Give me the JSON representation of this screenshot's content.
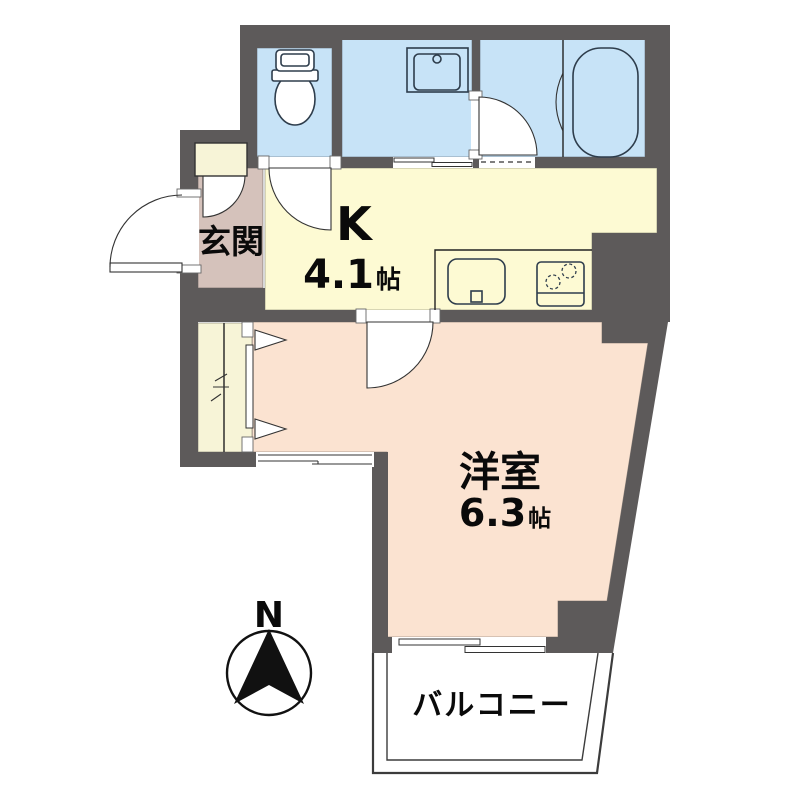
{
  "labels": {
    "genkan": "玄関",
    "kitchen": "K",
    "kitchen_size": "4.1",
    "kitchen_unit": "帖",
    "western_room": "洋室",
    "western_size": "6.3",
    "western_unit": "帖",
    "balcony": "バルコニー",
    "compass_north": "N"
  },
  "colors": {
    "wall": "#5d5a5a",
    "wet_room": "#c7e3f7",
    "kitchen": "#fdfad3",
    "western_room": "#fbe3d1",
    "genkan": "#d5c2bb",
    "closet": "#f7f4d7"
  }
}
